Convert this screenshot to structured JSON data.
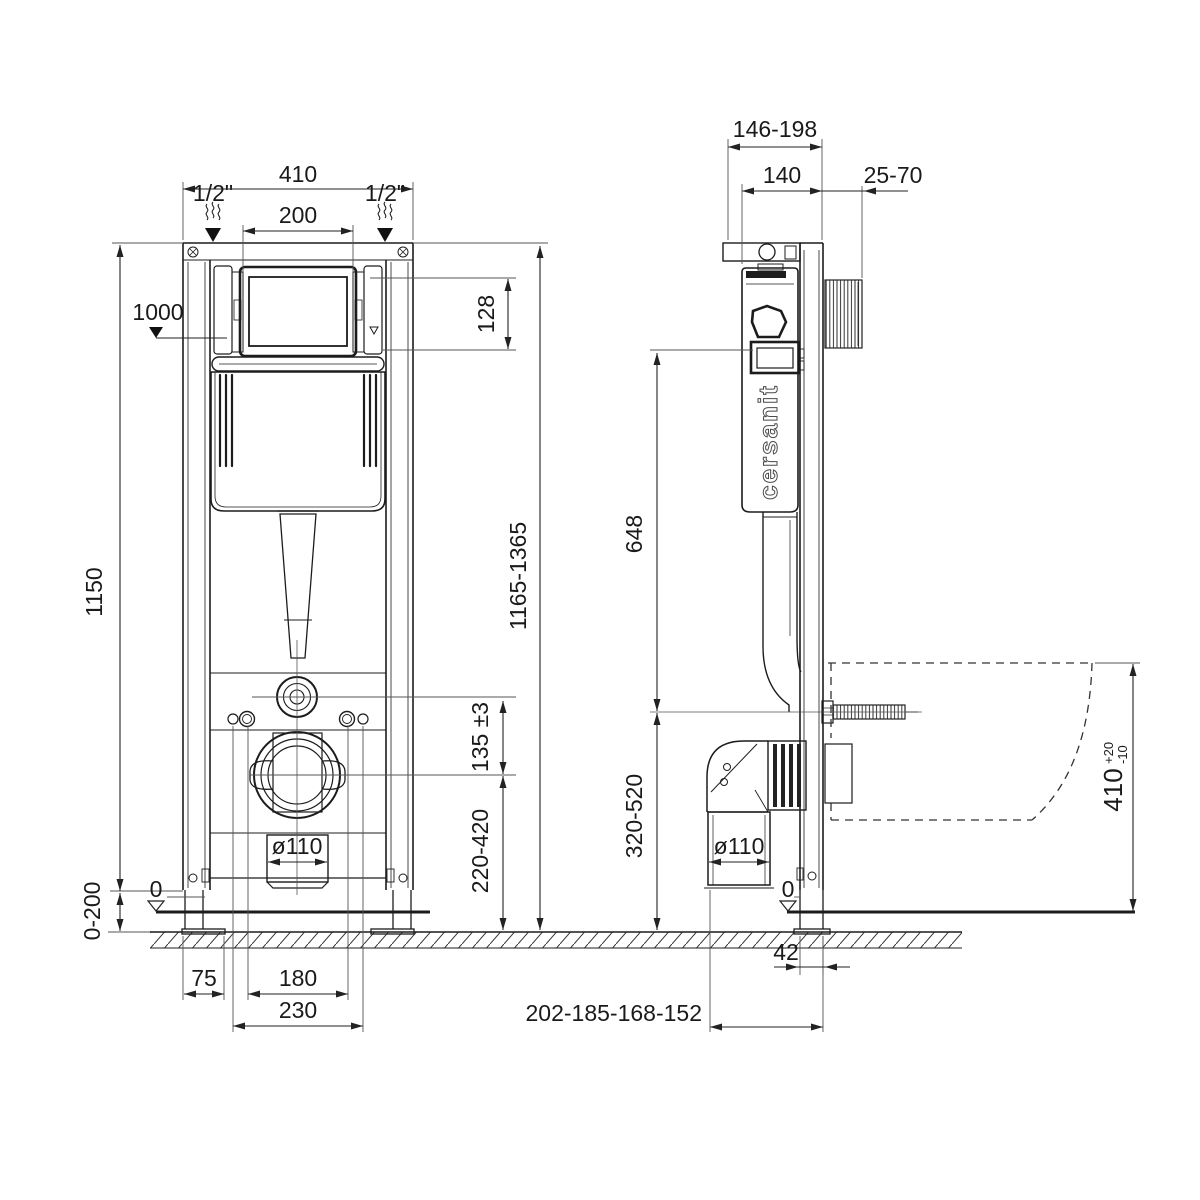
{
  "page": {
    "background": "#ffffff",
    "line_color": "#1c1c1c"
  },
  "drawing": {
    "front": {
      "width_total": "410",
      "supply_left": "1/2\"",
      "supply_right": "1/2\"",
      "opening_width": "200",
      "button_height_ref": "1000",
      "opening_height": "128",
      "frame_height": "1150",
      "total_height_range": "1165-1365",
      "flush_offset": "135 ±3",
      "drain_height_range": "220-420",
      "outlet_diameter": "ø110",
      "floor_zero": "0",
      "leg_adjustment": "0-200",
      "foot_width": "75",
      "fixing_span_inner": "180",
      "fixing_span_outer": "230"
    },
    "side": {
      "depth_total_range": "146-198",
      "frame_depth": "140",
      "wall_clearance": "25-70",
      "flush_drop": "648",
      "drain_height_range": "320-520",
      "outlet_diameter": "ø110",
      "floor_zero": "0",
      "profile_depth": "42",
      "outlet_wall_distances": "202-185-168-152",
      "bowl_height": "410",
      "bowl_height_tol_plus": "+20",
      "bowl_height_tol_minus": "-10",
      "logo": "cersanit"
    }
  }
}
